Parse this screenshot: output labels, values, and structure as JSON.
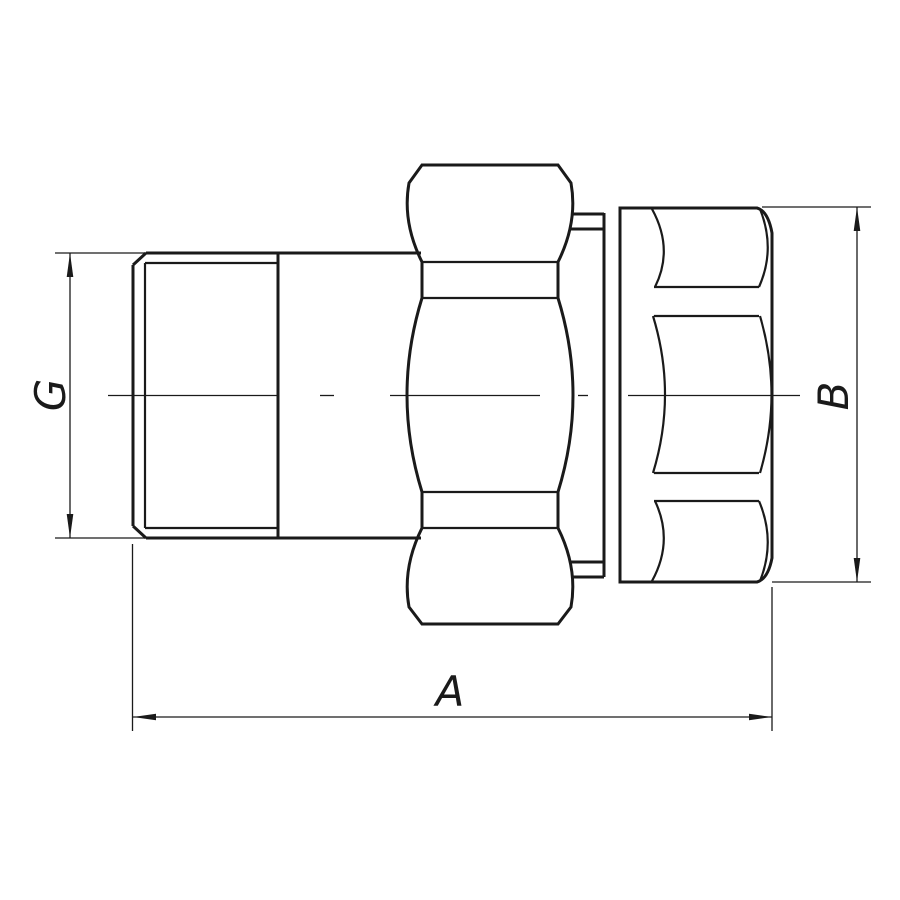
{
  "drawing": {
    "title": "pipe-union-fitting-side-view",
    "labels": {
      "g": "G",
      "a": "A",
      "b": "B"
    },
    "colors": {
      "line": "#1a1a1a",
      "background": "#ffffff"
    }
  }
}
